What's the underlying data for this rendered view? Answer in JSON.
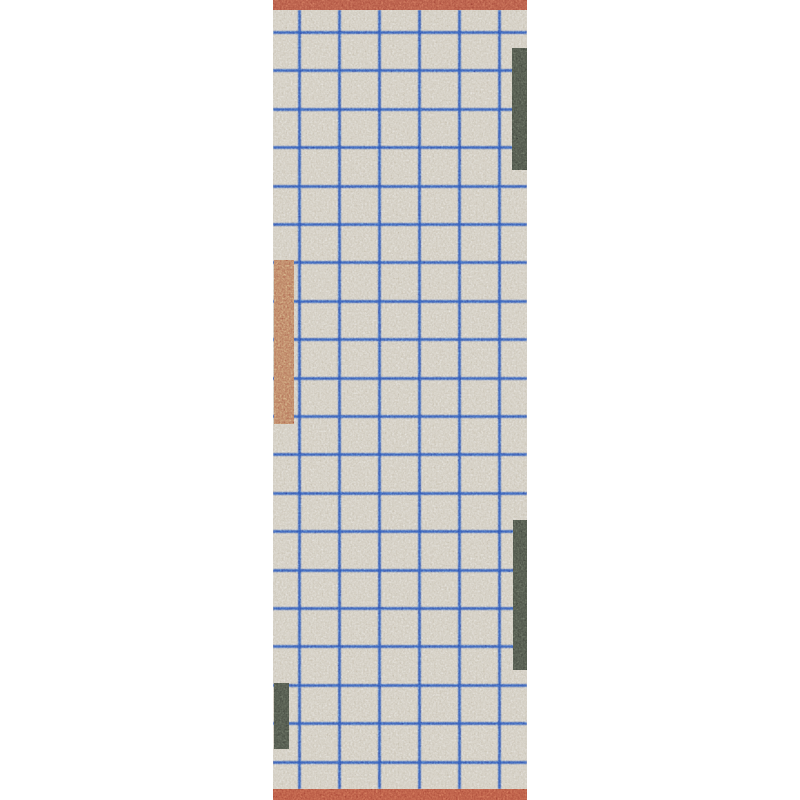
{
  "canvas": {
    "width": 800,
    "height": 800,
    "background_color": "#ffffff"
  },
  "rug": {
    "left": 273,
    "top": 0,
    "width": 254,
    "height": 800,
    "base_color": "#d5cfc2",
    "grid_line_color": "#2e55b8",
    "top_stripe": {
      "color": "#b65845",
      "top": 0,
      "height": 10
    },
    "bottom_stripe": {
      "color": "#b95742",
      "top": 789,
      "height": 11
    },
    "grid": {
      "line_thickness": 3,
      "vertical_line_offsets": [
        25,
        65,
        105,
        145,
        185,
        225
      ],
      "vertical_inset_top": 10,
      "vertical_inset_bottom": 11,
      "horizontal_start": 31,
      "horizontal_spacing": 38.4,
      "horizontal_count": 20
    },
    "accent_blocks": [
      {
        "name": "accent-block-top-right",
        "color": "#4e5449",
        "left": 239,
        "top": 48,
        "width": 15,
        "height": 122
      },
      {
        "name": "accent-block-middle-left",
        "color": "#bd7e61",
        "left": 1,
        "top": 260,
        "width": 20,
        "height": 164
      },
      {
        "name": "accent-block-bottom-right",
        "color": "#4e5449",
        "left": 240,
        "top": 520,
        "width": 14,
        "height": 150
      },
      {
        "name": "accent-block-bottom-left",
        "color": "#4e5449",
        "left": 1,
        "top": 683,
        "width": 15,
        "height": 66
      }
    ]
  }
}
